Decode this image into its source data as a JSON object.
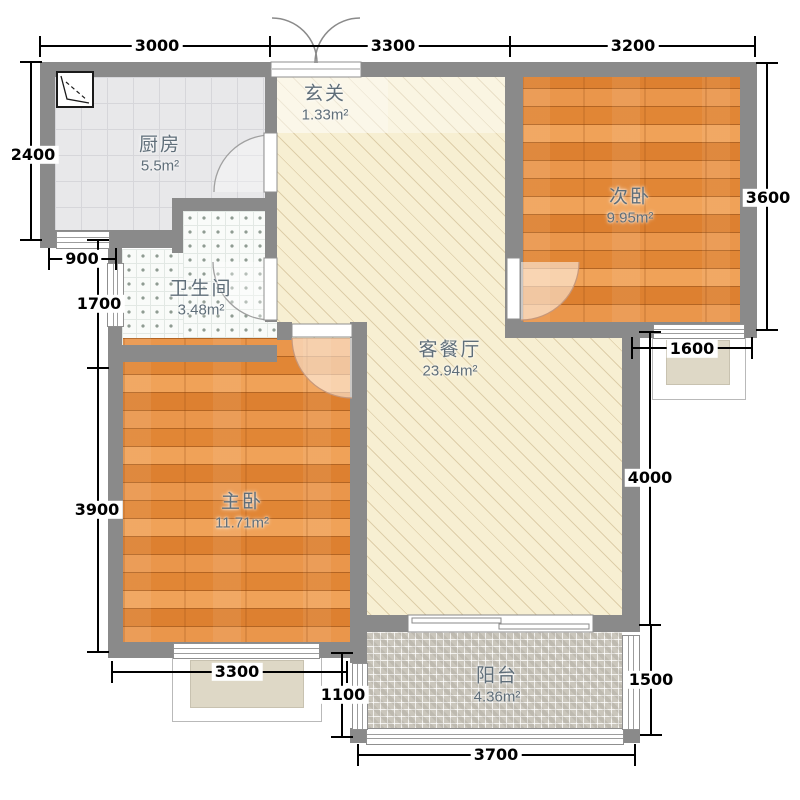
{
  "plan": {
    "rooms": {
      "kitchen": {
        "name": "厨房",
        "area": "5.5m²"
      },
      "entry": {
        "name": "玄关",
        "area": "1.33m²"
      },
      "bedroom2": {
        "name": "次卧",
        "area": "9.95m²"
      },
      "bathroom": {
        "name": "卫生间",
        "area": "3.48m²"
      },
      "living": {
        "name": "客餐厅",
        "area": "23.94m²"
      },
      "master": {
        "name": "主卧",
        "area": "11.71m²"
      },
      "balcony": {
        "name": "阳台",
        "area": "4.36m²"
      }
    },
    "dimensions": {
      "top": [
        "3000",
        "3300",
        "3200"
      ],
      "left": [
        "2400",
        "900",
        "1700",
        "3900"
      ],
      "right": [
        "3600",
        "1600",
        "4000",
        "1500"
      ],
      "bottom": [
        "3300",
        "1100",
        "3700"
      ]
    },
    "colors": {
      "wall": "#8a8a8a",
      "wood_floor": "#e28a3c",
      "living_floor": "#f7efd2",
      "kitchen_floor": "#e8e8ea",
      "bath_floor": "#f9fbf9",
      "balcony_floor": "#cac6bc",
      "bay_window_fill": "#ded8c6",
      "dimension_text": "#000000",
      "room_label_text": "#5f6e79"
    }
  }
}
